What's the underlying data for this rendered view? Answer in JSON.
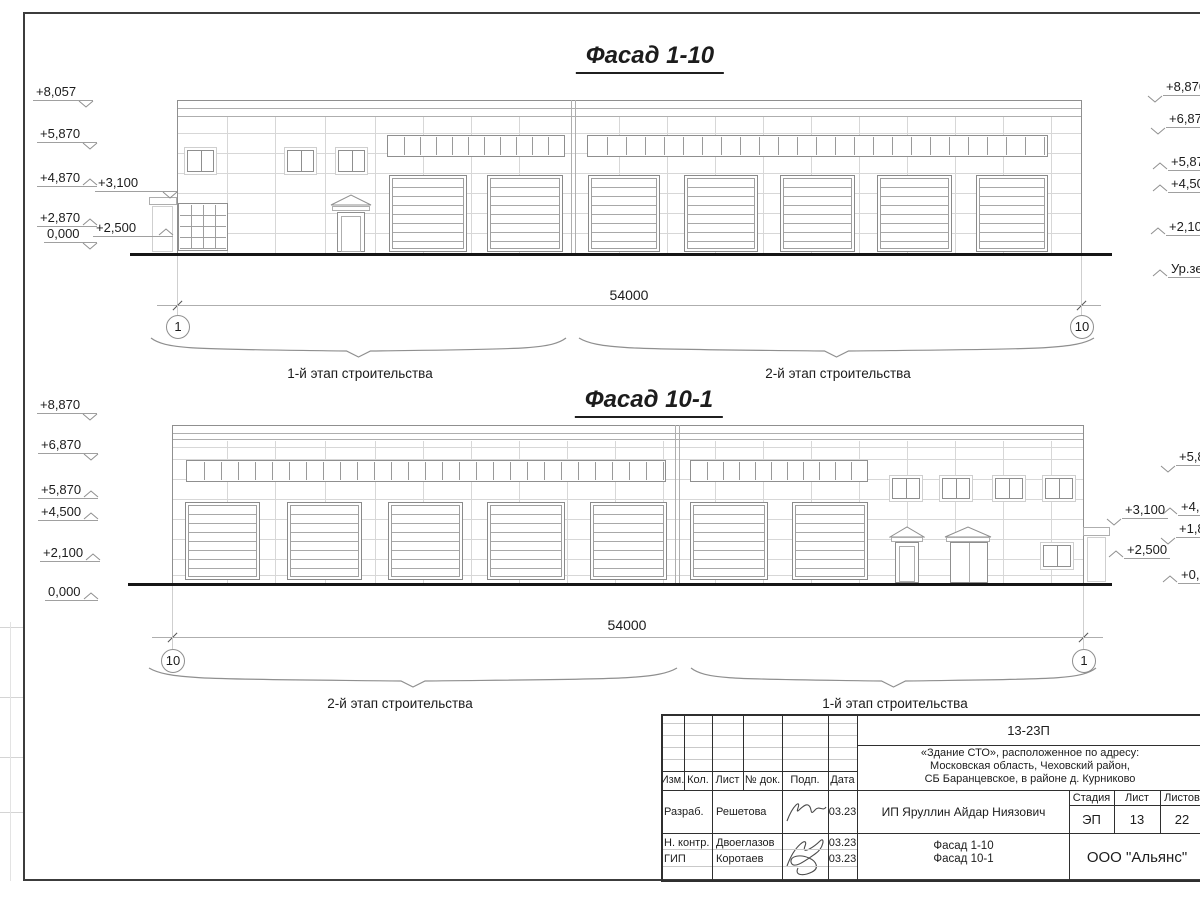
{
  "f1": {
    "title": "Фасад 1-10",
    "dim": "54000",
    "axisL": "1",
    "axisR": "10",
    "stageL": "1-й этап строительства",
    "stageR": "2-й этап строительства",
    "levels_left": [
      "+8,057",
      "+5,870",
      "+4,870",
      "+2,870",
      "0,000"
    ],
    "levels_left_inner": [
      "+3,100",
      "+2,500"
    ],
    "levels_right": [
      "+8,870",
      "+6,870",
      "+5,87",
      "+4,50",
      "+2,10",
      "Ур.зе"
    ]
  },
  "f2": {
    "title": "Фасад 10-1",
    "dim": "54000",
    "axisL": "10",
    "axisR": "1",
    "stageL": "2-й этап строительства",
    "stageR": "1-й этап строительства",
    "levels_left": [
      "+8,870",
      "+6,870",
      "+5,870",
      "+4,500",
      "+2,100",
      "0,000"
    ],
    "levels_right_inner": [
      "+3,100",
      "+2,500"
    ],
    "levels_right": [
      "+5,8",
      "+4,8",
      "+1,8",
      "+0,8"
    ]
  },
  "title_block": {
    "code": "13-23П",
    "project_line1": "«Здание СТО», расположенное по адресу:",
    "project_line2": "Московская область, Чеховский район,",
    "project_line3": "СБ Баранцевское, в районе д. Курниково",
    "columns": [
      "Изм.",
      "Кол.",
      "Лист",
      "№ док.",
      "Подп.",
      "Дата"
    ],
    "rows": [
      {
        "role": "Разраб.",
        "name": "Решетова",
        "date": "03.23"
      },
      {
        "role": "Н. контр.",
        "name": "Двоеглазов",
        "date": "03.23"
      },
      {
        "role": "ГИП",
        "name": "Коротаев",
        "date": "03.23"
      }
    ],
    "client": "ИП Яруллин Айдар Ниязович",
    "stage_label": "Стадия",
    "sheet_label": "Лист",
    "sheets_label": "Листов",
    "stage": "ЭП",
    "sheet_no": "13",
    "sheets_total": "22",
    "drawing_name_line1": "Фасад 1-10",
    "drawing_name_line2": "Фасад 10-1",
    "organization": "ООО \"Альянс\""
  }
}
